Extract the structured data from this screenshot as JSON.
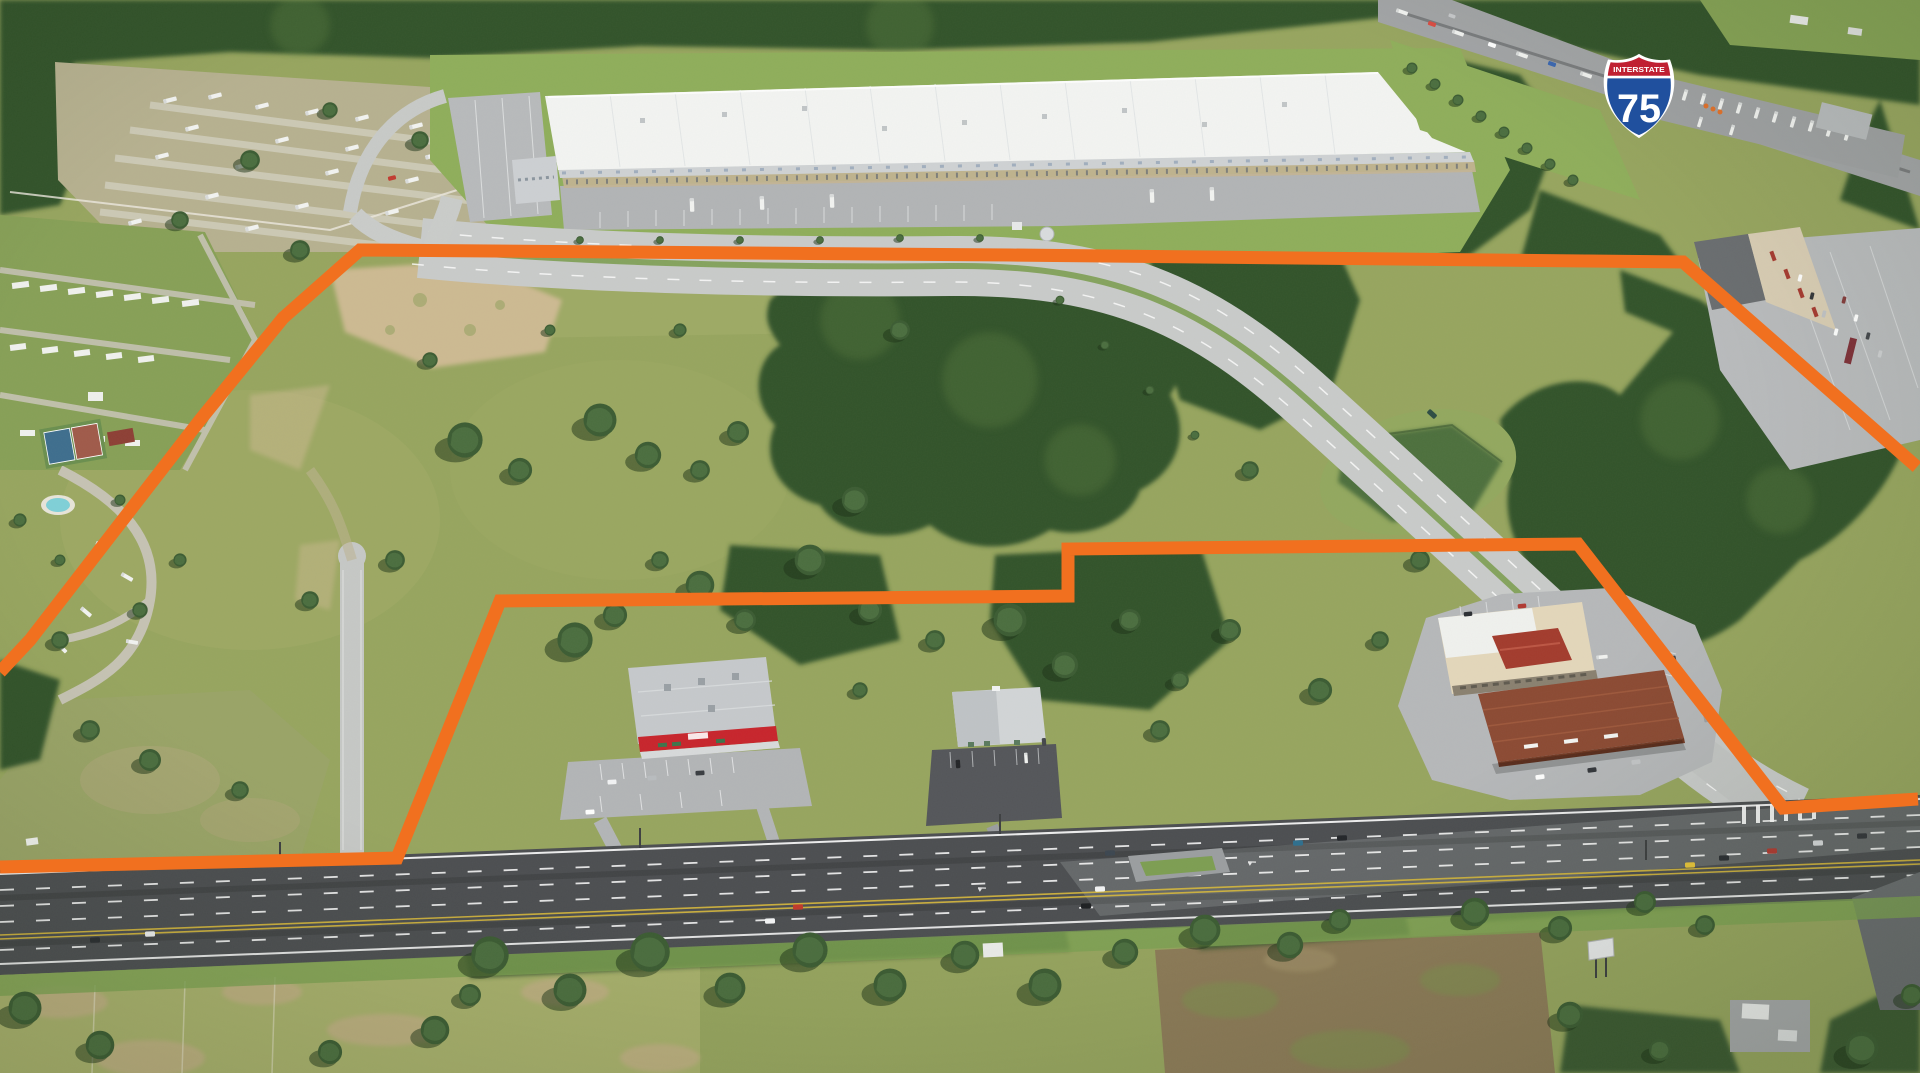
{
  "meta": {
    "title": "Aerial photograph of vacant commercial land parcel outlined in orange near Interstate 75",
    "image_type": "annotated-aerial-photograph"
  },
  "labels": {
    "shield_top": "INTERSTATE",
    "shield_number": "75"
  },
  "overlay": {
    "boundary_color": "#F1701F",
    "boundary_stroke_width": 13,
    "outer_boundary_points": "0,672 30,640 200,420 283,318 360,250 1010,255 1683,262 1917,467",
    "inner_boundary_points": "0,867 397,858 500,601 1068,596 1068,549 1578,544 1783,808 1918,799",
    "shield": {
      "top_label": "INTERSTATE",
      "number": "75",
      "red": "#C02032",
      "blue": "#20509E"
    }
  },
  "colors": {
    "orange": "#F1701F",
    "shield_red": "#C02032",
    "shield_blue": "#20509E",
    "grass": "#97A55F",
    "grass_bright": "#8FAE5B",
    "field_light": "#A8B06C",
    "forest": "#32522B",
    "dirt": "#CDBA92",
    "scrub": "#9AA468",
    "road_light": "#C9CBCA",
    "road_mid": "#A2A4A6",
    "asphalt": "#4C4E51",
    "warehouse": "#F3F4F2",
    "pond": "#4E6F3E",
    "canopy_brown": "#8C4A33",
    "store_red": "#C8242C",
    "plaza_beige": "#D9CDB4",
    "dirt_field": "#8D7B58"
  },
  "scene": {
    "regions": [
      "rv-park",
      "mobile-home-park",
      "rv-resort",
      "distribution-warehouse",
      "interstate-75-corridor",
      "truck-rest-area",
      "shopping-plaza",
      "vacant-parcel",
      "retention-pond",
      "connector-road",
      "auto-parts-store",
      "shed-building",
      "gas-station",
      "highway",
      "oak-tree-row",
      "dirt-field",
      "bottom-left-field"
    ]
  }
}
